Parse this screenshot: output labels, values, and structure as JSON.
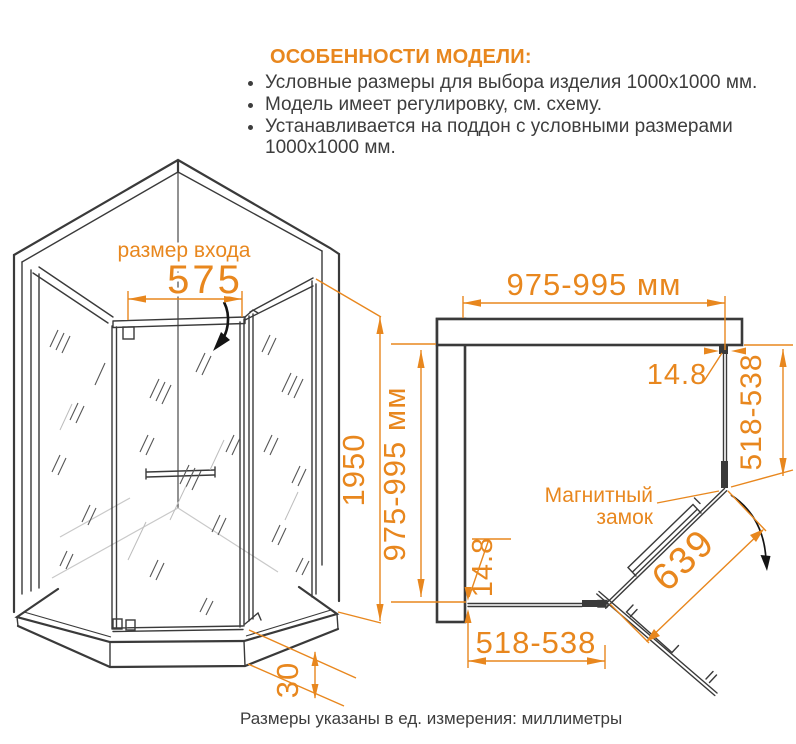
{
  "accent_color": "#E8871E",
  "line_color": "#3a3a3a",
  "header": {
    "title": "ОСОБЕННОСТИ МОДЕЛИ:",
    "bullets": [
      "Условные размеры для выбора изделия 1000x1000 мм.",
      "Модель имеет регулировку, см. схему.",
      "Устанавливается на поддон с условными размерами 1000x1000 мм."
    ]
  },
  "front_view": {
    "entrance_label": "размер входа",
    "entrance_width": "575",
    "height": "1950",
    "tray_height": "30"
  },
  "plan_view": {
    "top_width": "975-995 мм",
    "left_depth": "975-995 мм",
    "wall_gap_top_right": "14.8",
    "wall_gap_bottom_left": "14.8",
    "right_glass": "518-538",
    "bottom_glass": "518-538",
    "door_width": "639",
    "lock_label_line1": "Магнитный",
    "lock_label_line2": "замок"
  },
  "footer": {
    "note": "Размеры указаны в ед. измерения: миллиметры"
  }
}
